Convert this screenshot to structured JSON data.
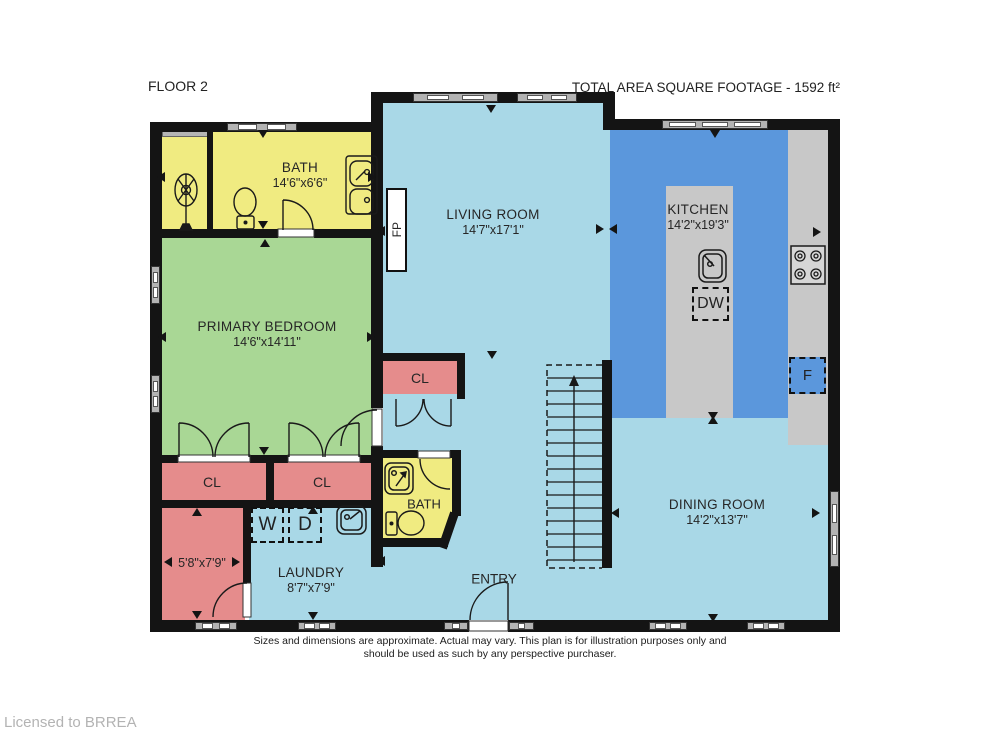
{
  "header": {
    "floor_label": "FLOOR 2",
    "total_area": "TOTAL AREA SQUARE FOOTAGE - 1592 ft²"
  },
  "rooms": {
    "bath_main": {
      "name": "BATH",
      "dims": "14'6\"x6'6\""
    },
    "living": {
      "name": "LIVING ROOM",
      "dims": "14'7\"x17'1\""
    },
    "kitchen": {
      "name": "KITCHEN",
      "dims": "14'2\"x19'3\""
    },
    "primary_bedroom": {
      "name": "PRIMARY BEDROOM",
      "dims": "14'6\"x14'11\""
    },
    "closet_hall": {
      "name": "CL"
    },
    "closet_left": {
      "name": "CL"
    },
    "closet_right": {
      "name": "CL"
    },
    "bath_small": {
      "name": "BATH"
    },
    "storage": {
      "dims": "5'8\"x7'9\""
    },
    "laundry": {
      "name": "LAUNDRY",
      "dims": "8'7\"x7'9\""
    },
    "entry": {
      "name": "ENTRY"
    },
    "dining": {
      "name": "DINING ROOM",
      "dims": "14'2\"x13'7\""
    }
  },
  "appliances": {
    "washer": "W",
    "dryer": "D",
    "dishwasher": "DW",
    "fridge": "F",
    "fireplace": "FP"
  },
  "footer": {
    "disclaimer_line1": "Sizes and dimensions are approximate. Actual may vary. This plan is for illustration purposes only and",
    "disclaimer_line2": "should be used as such by any perspective purchaser.",
    "license": "Licensed to BRREA"
  },
  "colors": {
    "wall": "#141414",
    "light_blue": "#A9D8E7",
    "kitchen_blue": "#5B97DC",
    "green": "#A9D795",
    "yellow": "#F0EB81",
    "pink": "#E58C8C",
    "gray": "#C8C8C8"
  }
}
